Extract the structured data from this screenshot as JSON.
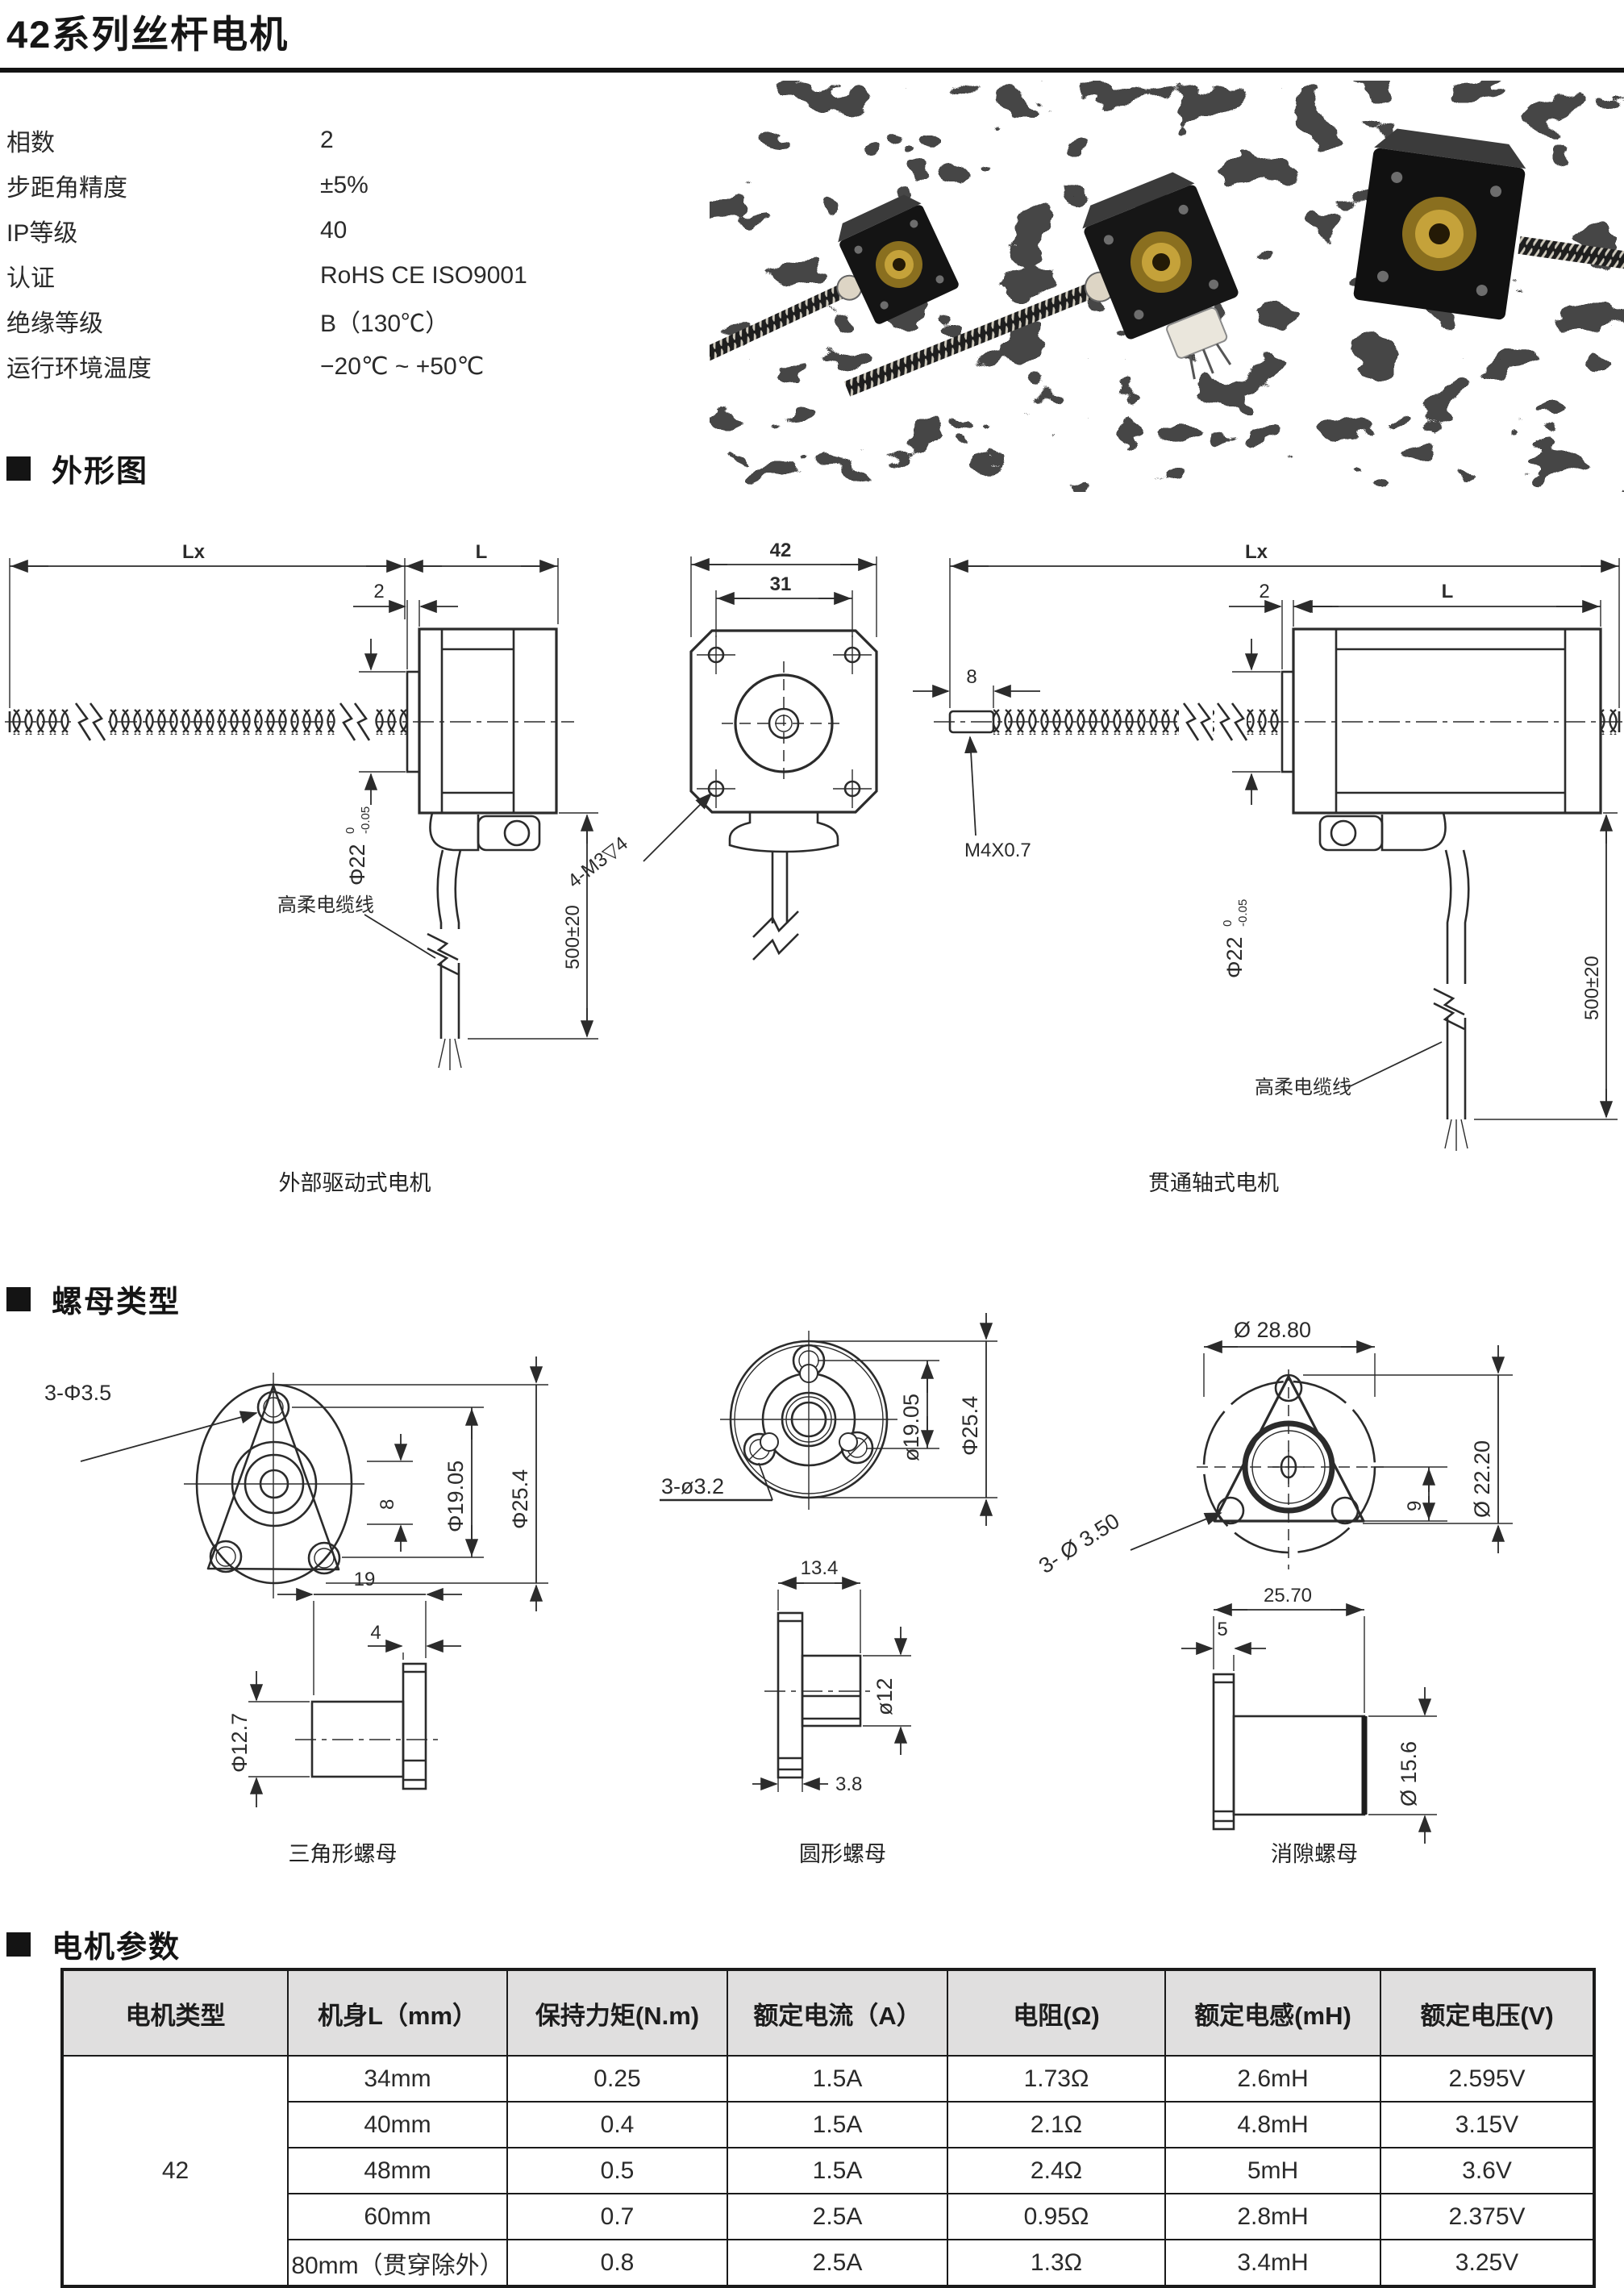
{
  "page": {
    "title": "42系列丝杆电机"
  },
  "colors": {
    "ink": "#2b2b2b",
    "table_header_bg": "#e0dfdf",
    "rule": "#121212"
  },
  "specs": {
    "items": [
      {
        "label": "相数",
        "value": "2"
      },
      {
        "label": "步距角精度",
        "value": "±5%"
      },
      {
        "label": "IP等级",
        "value": "40"
      },
      {
        "label": "认证",
        "value": "RoHS CE ISO9001"
      },
      {
        "label": "绝缘等级",
        "value": "B（130℃）"
      },
      {
        "label": "运行环境温度",
        "value": "−20℃ ~ +50℃"
      }
    ]
  },
  "sections": {
    "outline": "外形图",
    "nuts": "螺母类型",
    "params": "电机参数"
  },
  "drawings": {
    "outline_left": {
      "length_total": "Lx",
      "length_body": "L",
      "flange_thk": "2",
      "shaft_dia": "Φ22",
      "tol_upper": "0",
      "tol_lower": "-0.05",
      "cable_length": "500±20",
      "cable_label": "高柔电缆线",
      "caption": "外部驱动式电机"
    },
    "outline_front": {
      "width": "42",
      "hole_spacing": "31",
      "mount_holes": "4-M3▽4"
    },
    "outline_right": {
      "length_total": "Lx",
      "length_body": "L",
      "flange_thk": "2",
      "tip_len": "8",
      "tip_thread": "M4X0.7",
      "shaft_dia": "Φ22",
      "tol_upper": "0",
      "tol_lower": "-0.05",
      "cable_length": "500±20",
      "cable_label": "高柔电缆线",
      "caption": "贯通轴式电机"
    }
  },
  "nuts": {
    "triangle": {
      "holes": "3-Φ3.5",
      "height": "8",
      "bolt_circle": "Φ19.05",
      "outer_dia": "Φ25.4",
      "length": "19",
      "flange_thk": "4",
      "body_dia": "Φ12.7",
      "caption": "三角形螺母"
    },
    "round": {
      "holes": "3-ø3.2",
      "bolt_circle": "ø19.05",
      "outer_dia": "Φ25.4",
      "length": "13.4",
      "body_dia": "ø12",
      "flange_thk": "3.8",
      "caption": "圆形螺母"
    },
    "antibacklash": {
      "outer_dia": "Ø 28.80",
      "holes": "3- Ø 3.50",
      "offset": "9",
      "bolt_circle": "Ø 22.20",
      "length": "25.70",
      "flange_thk": "5",
      "body_dia": "Ø 15.6",
      "caption": "消隙螺母"
    }
  },
  "table": {
    "headers": [
      "电机类型",
      "机身L（mm）",
      "保持力矩(N.m)",
      "额定电流（A）",
      "电阻(Ω)",
      "额定电感(mH)",
      "额定电压(V)"
    ],
    "motor_type": "42",
    "rows": [
      {
        "cells": [
          "34mm",
          "0.25",
          "1.5A",
          "1.73Ω",
          "2.6mH",
          "2.595V"
        ]
      },
      {
        "cells": [
          "40mm",
          "0.4",
          "1.5A",
          "2.1Ω",
          "4.8mH",
          "3.15V"
        ]
      },
      {
        "cells": [
          "48mm",
          "0.5",
          "1.5A",
          "2.4Ω",
          "5mH",
          "3.6V"
        ]
      },
      {
        "cells": [
          "60mm",
          "0.7",
          "2.5A",
          "0.95Ω",
          "2.8mH",
          "2.375V"
        ]
      },
      {
        "cells": [
          "80mm（贯穿除外）",
          "0.8",
          "2.5A",
          "1.3Ω",
          "3.4mH",
          "3.25V"
        ]
      }
    ]
  }
}
